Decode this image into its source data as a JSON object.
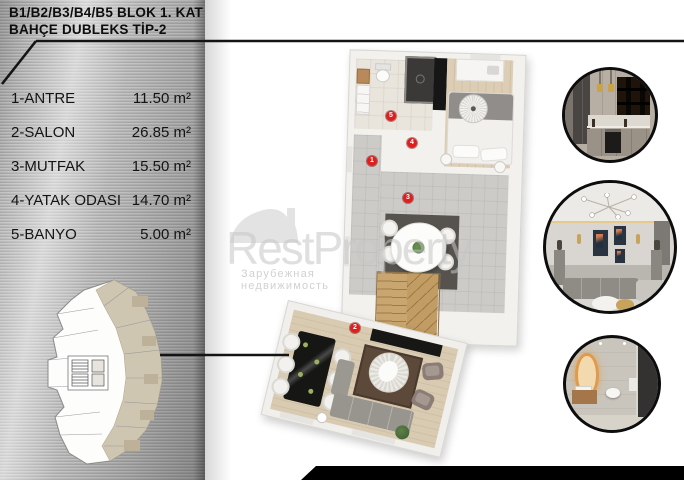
{
  "header": {
    "line1": "B1/B2/B3/B4/B5 BLOK 1. KAT",
    "line2": "BAHÇE DUBLEKS TİP-2"
  },
  "room_list": [
    {
      "label": "1-ANTRE",
      "area": "11.50 m²"
    },
    {
      "label": "2-SALON",
      "area": "26.85 m²"
    },
    {
      "label": "3-MUTFAK",
      "area": "15.50 m²"
    },
    {
      "label": "4-YATAK ODASI",
      "area": "14.70 m²"
    },
    {
      "label": "5-BANYO",
      "area": "5.00 m²"
    }
  ],
  "markers": [
    {
      "number": "1",
      "room": "antre",
      "x": 372,
      "y": 161
    },
    {
      "number": "2",
      "room": "salon",
      "x": 355,
      "y": 328
    },
    {
      "number": "3",
      "room": "mutfak",
      "x": 408,
      "y": 198
    },
    {
      "number": "4",
      "room": "yatak-odasi",
      "x": 412,
      "y": 143
    },
    {
      "number": "5",
      "room": "banyo",
      "x": 391,
      "y": 116
    }
  ],
  "watermark": {
    "brand": "RestProperty",
    "tagline": "Зарубежная недвижимость"
  },
  "photos": [
    {
      "name": "kitchen-photo"
    },
    {
      "name": "living-room-photo"
    },
    {
      "name": "bathroom-photo"
    }
  ],
  "colors": {
    "marker_red": "#e21d1d",
    "metal_gray": "#b3b3b3",
    "highlight_beige": "#cfc6b2",
    "line_black": "#141414"
  }
}
